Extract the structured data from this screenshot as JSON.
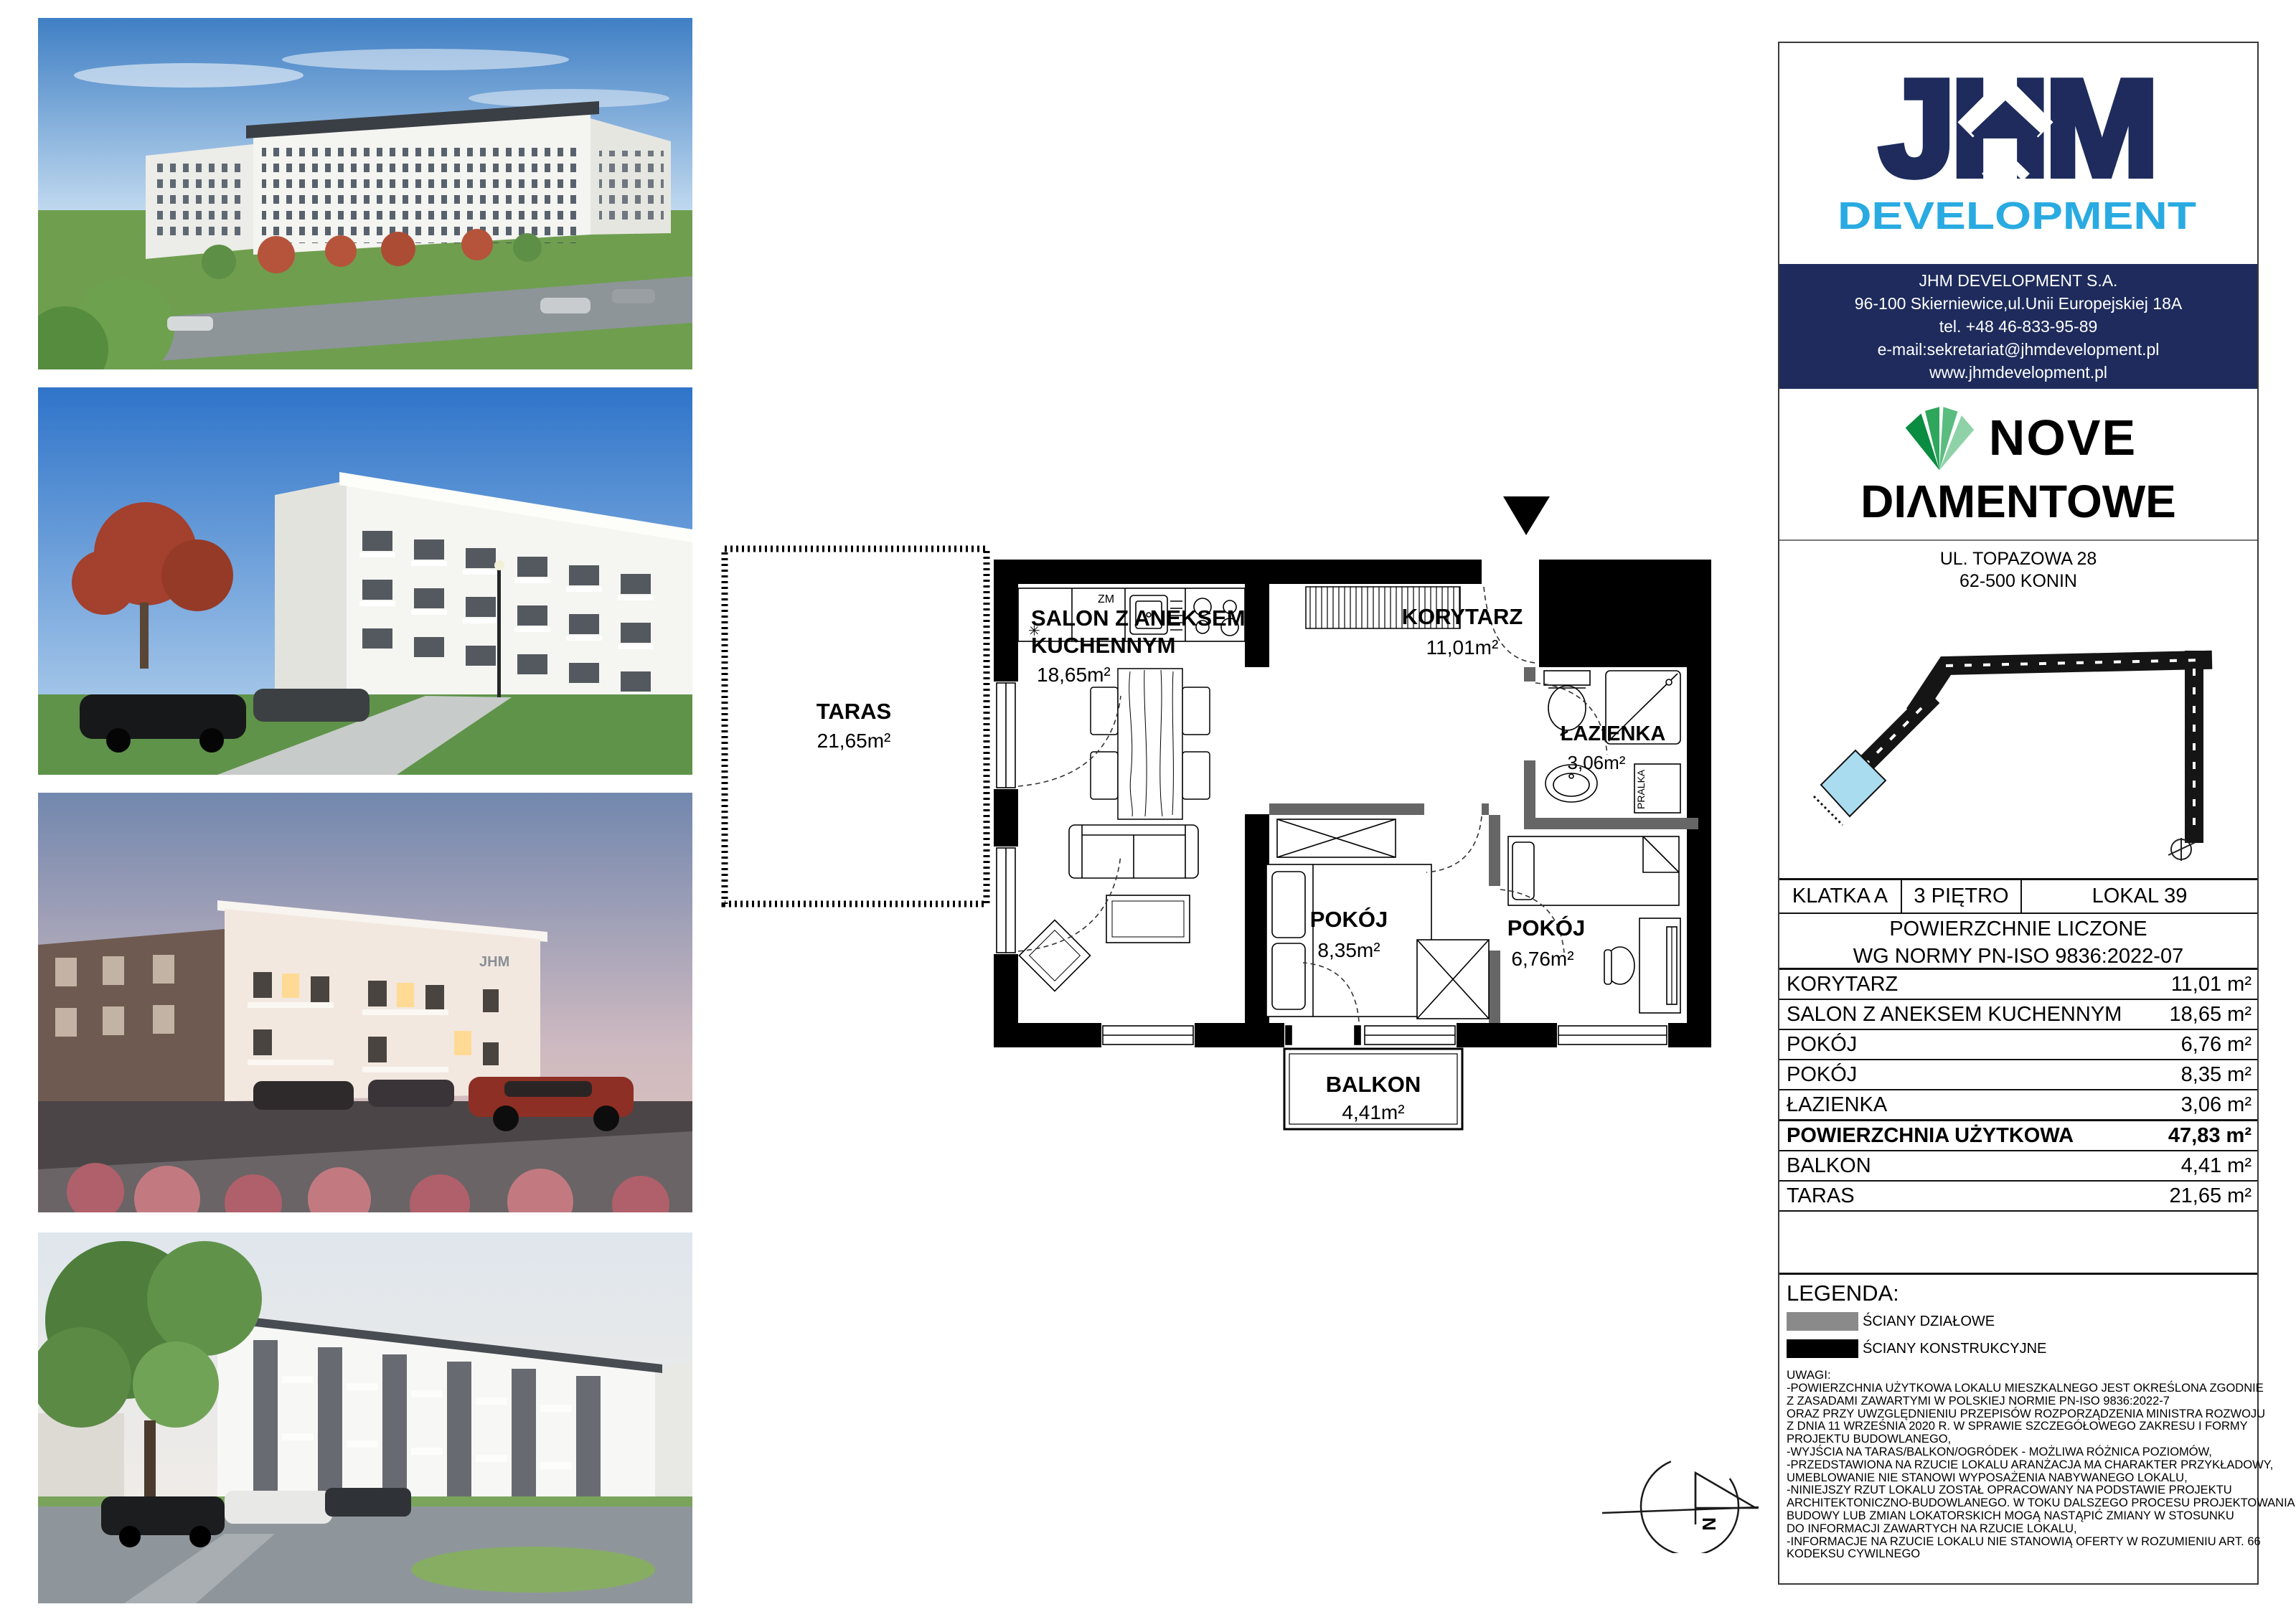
{
  "branding": {
    "logo_text": "JHM",
    "logo_sub": "DEVELOPMENT",
    "contact_lines": [
      "JHM DEVELOPMENT S.A.",
      "96-100 Skierniewice,ul.Unii Europejskiej 18A",
      "tel. +48 46-833-95-89",
      "e-mail:sekretariat@jhmdevelopment.pl",
      "www.jhmdevelopment.pl"
    ]
  },
  "project": {
    "name_line1": "NOVE",
    "name_line2": "DIΛMENTOWE",
    "address_line1": "UL. TOPAZOWA 28",
    "address_line2": "62-500 KONIN"
  },
  "unit_header": {
    "klatka": "KLATKA A",
    "pietro": "3 PIĘTRO",
    "lokal": "LOKAL 39"
  },
  "areas_table": {
    "title_line1": "POWIERZCHNIE LICZONE",
    "title_line2": "WG NORMY PN-ISO 9836:2022-07",
    "rows": [
      {
        "label": "KORYTARZ",
        "value": "11,01 m²",
        "bold": false
      },
      {
        "label": "SALON Z ANEKSEM KUCHENNYM",
        "value": "18,65 m²",
        "bold": false
      },
      {
        "label": "POKÓJ",
        "value": "6,76 m²",
        "bold": false
      },
      {
        "label": "POKÓJ",
        "value": "8,35 m²",
        "bold": false
      },
      {
        "label": "ŁAZIENKA",
        "value": "3,06 m²",
        "bold": false
      },
      {
        "label": "POWIERZCHNIA UŻYTKOWA",
        "value": "47,83 m²",
        "bold": true
      },
      {
        "label": "BALKON",
        "value": "4,41 m²",
        "bold": false
      },
      {
        "label": "TARAS",
        "value": "21,65 m²",
        "bold": false
      }
    ]
  },
  "legend": {
    "title": "LEGENDA:",
    "items": [
      {
        "label": "ŚCIANY DZIAŁOWE",
        "color": "#8a8a8a"
      },
      {
        "label": "ŚCIANY KONSTRUKCYJNE",
        "color": "#000000"
      }
    ]
  },
  "notes": {
    "title": "UWAGI:",
    "lines": [
      "-POWIERZCHNIA UŻYTKOWA LOKALU MIESZKALNEGO JEST OKREŚLONA ZGODNIE",
      "Z ZASADAMI ZAWARTYMI W POLSKIEJ NORMIE PN-ISO 9836:2022-7",
      "ORAZ PRZY UWZGLĘDNIENIU PRZEPISÓW ROZPORZĄDZENIA MINISTRA ROZWOJU",
      "Z DNIA 11 WRZEŚNIA 2020 R. W SPRAWIE SZCZEGÓŁOWEGO ZAKRESU I FORMY",
      "PROJEKTU BUDOWLANEGO,",
      "-WYJŚCIA NA TARAS/BALKON/OGRÓDEK - MOŻLIWA RÓŻNICA POZIOMÓW,",
      "-PRZEDSTAWIONA NA RZUCIE LOKALU ARANŻACJA MA CHARAKTER PRZYKŁADOWY,",
      "UMEBLOWANIE NIE STANOWI WYPOSAŻENIA NABYWANEGO LOKALU,",
      "-NINIEJSZY RZUT LOKALU ZOSTAŁ OPRACOWANY NA PODSTAWIE PROJEKTU",
      "ARCHITEKTONICZNO-BUDOWLANEGO. W TOKU DALSZEGO PROCESU PROJEKTOWANIA,",
      "BUDOWY LUB ZMIAN LOKATORSKICH MOGĄ NASTĄPIĆ ZMIANY W STOSUNKU",
      "DO INFORMACJI ZAWARTYCH NA RZUCIE LOKALU,",
      "-INFORMACJE NA RZUCIE LOKALU NIE STANOWIĄ OFERTY W ROZUMIENIU ART. 66",
      "KODEKSU CYWILNEGO"
    ]
  },
  "floorplan": {
    "rooms": {
      "taras": {
        "name": "TARAS",
        "area": "21,65m²"
      },
      "salon": {
        "name_line1": "SALON Z ANEKSEM",
        "name_line2": "KUCHENNYM",
        "area": "18,65m²"
      },
      "korytarz": {
        "name": "KORYTARZ",
        "area": "11,01m²"
      },
      "lazienka": {
        "name": "ŁAZIENKA",
        "area": "3,06m²"
      },
      "pokoj_a": {
        "name": "POKÓJ",
        "area": "8,35m²"
      },
      "pokoj_b": {
        "name": "POKÓJ",
        "area": "6,76m²"
      },
      "balkon": {
        "name": "BALKON",
        "area": "4,41m²"
      }
    },
    "labels": {
      "dishwasher": "ZM",
      "washer": "PRALKA",
      "north": "N",
      "photo_sign": "JHM"
    }
  },
  "colors": {
    "navy": "#1e2b5c",
    "cyan": "#29abe2",
    "partition": "#666666",
    "structural": "#000000",
    "unit_highlight": "#aadcf0"
  }
}
